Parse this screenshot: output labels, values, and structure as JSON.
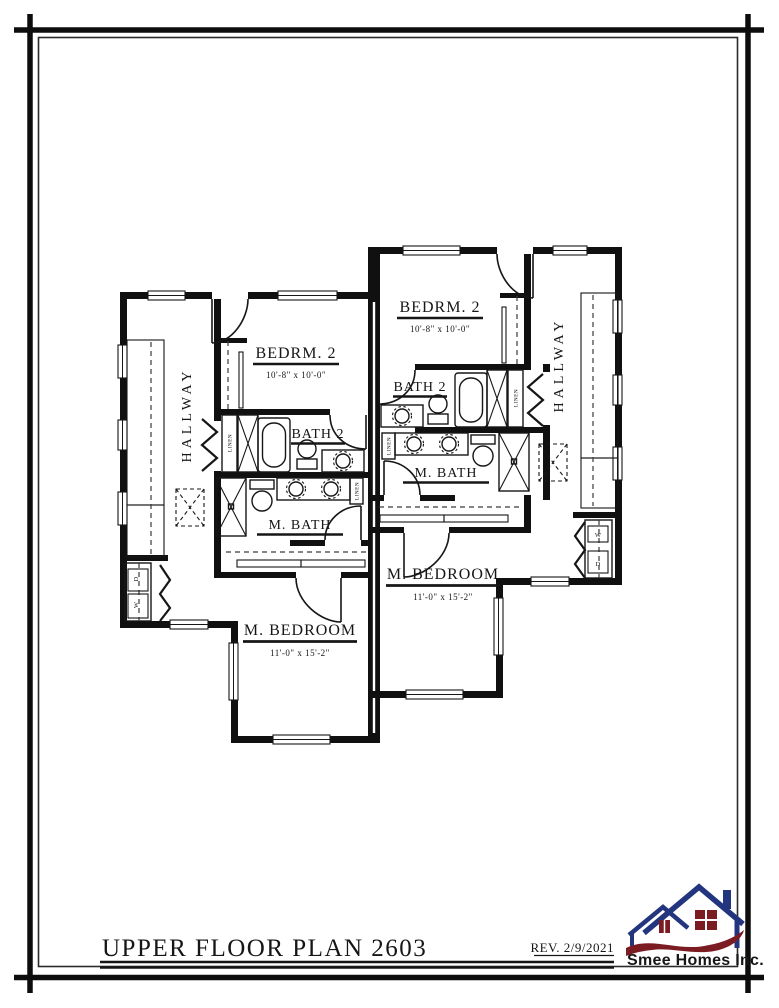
{
  "sheet": {
    "title": "UPPER FLOOR PLAN 2603",
    "revision": "REV. 2/9/2021"
  },
  "logo": {
    "company": "Smee Homes Inc.",
    "blue": "#23357f",
    "red": "#7b1b22"
  },
  "rooms": {
    "left": {
      "hallway": "HALLWAY",
      "bedroom2": "BEDRM. 2",
      "bedroom2_dim": "10'-8\" x 10'-0\"",
      "bath2": "BATH 2",
      "master_bath": "M. BATH",
      "master_bedroom": "M. BEDROOM",
      "master_bedroom_dim": "11'-0\" x 15'-2\"",
      "linen_hall": "LINEN",
      "linen_bath": "LINEN",
      "dryer": "D",
      "washer": "W"
    },
    "right": {
      "hallway": "HALLWAY",
      "bedroom2": "BEDRM. 2",
      "bedroom2_dim": "10'-8\" x 10'-0\"",
      "bath2": "BATH 2",
      "master_bath": "M. BATH",
      "master_bedroom": "M. BEDROOM",
      "master_bedroom_dim": "11'-0\" x 15'-2\"",
      "linen_hall": "LINEN",
      "linen_bath": "LINEN",
      "dryer": "D",
      "washer": "W"
    }
  }
}
